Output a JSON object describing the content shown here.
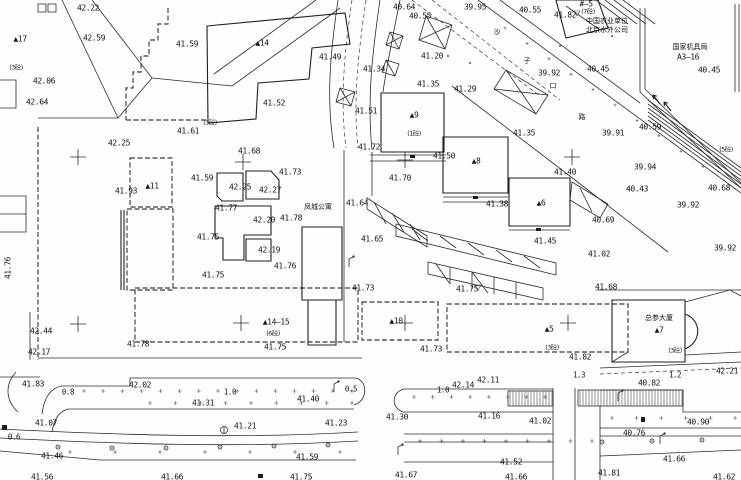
{
  "map_type": "cad-topographic-site-plan",
  "colors": {
    "background": "#fefefe",
    "linework": "#2b2b2b",
    "text": "#141414"
  },
  "street_name_vertical": [
    "沙",
    "子",
    "口",
    "路"
  ],
  "named_places": [
    "凤城公寓",
    "总参大厦",
    "中国农业单位",
    "北京水外公司",
    "国家机具局 A3—16"
  ],
  "building_numbers": [
    "▲17",
    "▲14",
    "▲11",
    "▲9",
    "▲8",
    "▲6",
    "▲14—15",
    "▲10",
    "▲5",
    "▲7"
  ],
  "storey_notes": [
    "(3砼)",
    "(1砼)",
    "(7砼)",
    "(6砼)",
    "(3砼)",
    "(5砼)"
  ],
  "survey_crosses": [
    [
      78,
      157
    ],
    [
      243,
      162
    ],
    [
      405,
      160
    ],
    [
      572,
      157
    ],
    [
      78,
      324
    ],
    [
      241,
      323
    ],
    [
      405,
      323
    ],
    [
      568,
      323
    ]
  ],
  "labels": [
    {
      "t": "42.22",
      "x": 88,
      "y": 8
    },
    {
      "t": "42.59",
      "x": 94,
      "y": 38
    },
    {
      "t": "▲17",
      "x": 20,
      "y": 39,
      "c": "bld"
    },
    {
      "t": "(3砼)",
      "x": 16,
      "y": 68,
      "c": "cn2"
    },
    {
      "t": "42.06",
      "x": 44,
      "y": 81
    },
    {
      "t": "42.64",
      "x": 37,
      "y": 102
    },
    {
      "t": "41.59",
      "x": 187,
      "y": 44
    },
    {
      "t": "▲14",
      "x": 262,
      "y": 43,
      "c": "bld"
    },
    {
      "t": "41.49",
      "x": 330,
      "y": 57
    },
    {
      "t": "41.52",
      "x": 274,
      "y": 103
    },
    {
      "t": "41.61",
      "x": 188,
      "y": 131
    },
    {
      "t": "(3砼)",
      "x": 210,
      "y": 123,
      "c": "cn2"
    },
    {
      "t": "42.25",
      "x": 119,
      "y": 143
    },
    {
      "t": "40.64",
      "x": 404,
      "y": 7
    },
    {
      "t": "40.55",
      "x": 420,
      "y": 16
    },
    {
      "t": "39.95",
      "x": 475,
      "y": 7
    },
    {
      "t": "41.20",
      "x": 432,
      "y": 56
    },
    {
      "t": "41.34",
      "x": 374,
      "y": 69
    },
    {
      "t": "41.35",
      "x": 428,
      "y": 84
    },
    {
      "t": "41.29",
      "x": 465,
      "y": 89
    },
    {
      "t": "41.51",
      "x": 366,
      "y": 111
    },
    {
      "t": "41.72",
      "x": 369,
      "y": 147
    },
    {
      "t": "▲9",
      "x": 414,
      "y": 115,
      "c": "bld"
    },
    {
      "t": "(1砼)",
      "x": 414,
      "y": 134,
      "c": "cn2"
    },
    {
      "t": "41.50",
      "x": 444,
      "y": 156
    },
    {
      "t": "41.70",
      "x": 400,
      "y": 178
    },
    {
      "t": "41.35",
      "x": 524,
      "y": 133
    },
    {
      "t": "41.40",
      "x": 565,
      "y": 172
    },
    {
      "t": "▲8",
      "x": 476,
      "y": 161,
      "c": "bld"
    },
    {
      "t": "41.38",
      "x": 497,
      "y": 204
    },
    {
      "t": "▲6",
      "x": 541,
      "y": 203,
      "c": "bld"
    },
    {
      "t": "41.45",
      "x": 545,
      "y": 241
    },
    {
      "t": "41.64",
      "x": 357,
      "y": 203
    },
    {
      "t": "凤城公寓",
      "x": 318,
      "y": 207,
      "c": "cn"
    },
    {
      "t": "41.65",
      "x": 372,
      "y": 239
    },
    {
      "t": "41.73",
      "x": 363,
      "y": 288
    },
    {
      "t": "41.75",
      "x": 467,
      "y": 289
    },
    {
      "t": "40.55",
      "x": 530,
      "y": 10
    },
    {
      "t": "41.82",
      "x": 565,
      "y": 15
    },
    {
      "t": "#—5",
      "x": 586,
      "y": 4
    },
    {
      "t": "(7砼)",
      "x": 588,
      "y": 12,
      "c": "cn2"
    },
    {
      "t": "中国农业单位",
      "x": 607,
      "y": 21,
      "c": "cn"
    },
    {
      "t": "北京水外公司",
      "x": 607,
      "y": 30,
      "c": "cn"
    },
    {
      "t": "国家机具局",
      "x": 690,
      "y": 47,
      "c": "cn"
    },
    {
      "t": "A3—16",
      "x": 688,
      "y": 57
    },
    {
      "t": "沙",
      "x": 497,
      "y": 32,
      "c": "cn"
    },
    {
      "t": "子",
      "x": 527,
      "y": 61,
      "c": "cn"
    },
    {
      "t": "口",
      "x": 553,
      "y": 86,
      "c": "cn"
    },
    {
      "t": "路",
      "x": 582,
      "y": 117,
      "c": "cn"
    },
    {
      "t": "39.92",
      "x": 549,
      "y": 73
    },
    {
      "t": "40.45",
      "x": 598,
      "y": 69
    },
    {
      "t": "40.45",
      "x": 709,
      "y": 70
    },
    {
      "t": "39.91",
      "x": 613,
      "y": 133
    },
    {
      "t": "40.59",
      "x": 650,
      "y": 127
    },
    {
      "t": "39.94",
      "x": 645,
      "y": 167
    },
    {
      "t": "40.43",
      "x": 637,
      "y": 189
    },
    {
      "t": "40.68",
      "x": 719,
      "y": 188
    },
    {
      "t": "39.92",
      "x": 688,
      "y": 205
    },
    {
      "t": "40.69",
      "x": 603,
      "y": 220
    },
    {
      "t": "39.92",
      "x": 725,
      "y": 248
    },
    {
      "t": "41.02",
      "x": 599,
      "y": 254
    },
    {
      "t": "(5砼)",
      "x": 726,
      "y": 150,
      "c": "cn2"
    },
    {
      "t": "41.68",
      "x": 606,
      "y": 287
    },
    {
      "t": "41.93",
      "x": 126,
      "y": 191
    },
    {
      "t": "▲11",
      "x": 152,
      "y": 186,
      "c": "bld"
    },
    {
      "t": "41.59",
      "x": 202,
      "y": 178
    },
    {
      "t": "41.68",
      "x": 249,
      "y": 151
    },
    {
      "t": "41.73",
      "x": 290,
      "y": 172
    },
    {
      "t": "42.25",
      "x": 240,
      "y": 187
    },
    {
      "t": "42.27",
      "x": 270,
      "y": 190
    },
    {
      "t": "41.77",
      "x": 226,
      "y": 208
    },
    {
      "t": "42.20",
      "x": 264,
      "y": 220
    },
    {
      "t": "41.78",
      "x": 291,
      "y": 218
    },
    {
      "t": "41.75",
      "x": 208,
      "y": 237
    },
    {
      "t": "42.19",
      "x": 269,
      "y": 250
    },
    {
      "t": "41.76",
      "x": 285,
      "y": 266
    },
    {
      "t": "41.75",
      "x": 213,
      "y": 275
    },
    {
      "t": "42.44",
      "x": 41,
      "y": 331
    },
    {
      "t": "42.17",
      "x": 39,
      "y": 352
    },
    {
      "t": "41.83",
      "x": 33,
      "y": 384
    },
    {
      "t": "41.76",
      "x": 8,
      "y": 268,
      "r": -90
    },
    {
      "t": "▲14—15",
      "x": 276,
      "y": 322,
      "c": "bld"
    },
    {
      "t": "(6砼)",
      "x": 273,
      "y": 334,
      "c": "cn2"
    },
    {
      "t": "41.75",
      "x": 275,
      "y": 347
    },
    {
      "t": "41.78",
      "x": 138,
      "y": 344
    },
    {
      "t": "▲10",
      "x": 396,
      "y": 321,
      "c": "bld"
    },
    {
      "t": "41.73",
      "x": 431,
      "y": 349
    },
    {
      "t": "▲5",
      "x": 549,
      "y": 329,
      "c": "bld"
    },
    {
      "t": "(3砼)",
      "x": 552,
      "y": 348,
      "c": "cn2"
    },
    {
      "t": "41.82",
      "x": 580,
      "y": 357
    },
    {
      "t": "总参大厦",
      "x": 659,
      "y": 318,
      "c": "cn"
    },
    {
      "t": "▲7",
      "x": 659,
      "y": 330,
      "c": "bld"
    },
    {
      "t": "(3砼)",
      "x": 675,
      "y": 351,
      "c": "cn2"
    },
    {
      "t": "0.8",
      "x": 68,
      "y": 392,
      "c": "dim"
    },
    {
      "t": "42.02",
      "x": 140,
      "y": 385
    },
    {
      "t": "1.0",
      "x": 230,
      "y": 392,
      "c": "dim"
    },
    {
      "t": "41.31",
      "x": 203,
      "y": 403
    },
    {
      "t": "0.5",
      "x": 351,
      "y": 389,
      "c": "dim"
    },
    {
      "t": "41.40",
      "x": 308,
      "y": 399
    },
    {
      "t": "41.07",
      "x": 46,
      "y": 423
    },
    {
      "t": "0.6",
      "x": 14,
      "y": 437,
      "c": "dim"
    },
    {
      "t": "41.21",
      "x": 245,
      "y": 426
    },
    {
      "t": "41.23",
      "x": 336,
      "y": 423
    },
    {
      "t": "41.46",
      "x": 52,
      "y": 456
    },
    {
      "t": "41.56",
      "x": 42,
      "y": 477
    },
    {
      "t": "41.66",
      "x": 172,
      "y": 477
    },
    {
      "t": "41.59",
      "x": 307,
      "y": 457
    },
    {
      "t": "41.75",
      "x": 301,
      "y": 477
    },
    {
      "t": "41.30",
      "x": 397,
      "y": 417
    },
    {
      "t": "1.0",
      "x": 443,
      "y": 390,
      "c": "dim"
    },
    {
      "t": "42.14",
      "x": 463,
      "y": 385
    },
    {
      "t": "42.11",
      "x": 488,
      "y": 380
    },
    {
      "t": "41.16",
      "x": 489,
      "y": 416
    },
    {
      "t": "41.67",
      "x": 406,
      "y": 475
    },
    {
      "t": "1.3",
      "x": 579,
      "y": 375,
      "c": "dim"
    },
    {
      "t": "1.2",
      "x": 675,
      "y": 375,
      "c": "dim"
    },
    {
      "t": "42.21",
      "x": 727,
      "y": 371
    },
    {
      "t": "40.82",
      "x": 649,
      "y": 383
    },
    {
      "t": "41.02",
      "x": 540,
      "y": 421
    },
    {
      "t": "40.90",
      "x": 698,
      "y": 422
    },
    {
      "t": "40.76",
      "x": 634,
      "y": 433
    },
    {
      "t": "41.52",
      "x": 511,
      "y": 462
    },
    {
      "t": "41.66",
      "x": 674,
      "y": 459
    },
    {
      "t": "41.66",
      "x": 516,
      "y": 477
    },
    {
      "t": "41.81",
      "x": 609,
      "y": 473
    },
    {
      "t": "41.62",
      "x": 724,
      "y": 477
    }
  ]
}
